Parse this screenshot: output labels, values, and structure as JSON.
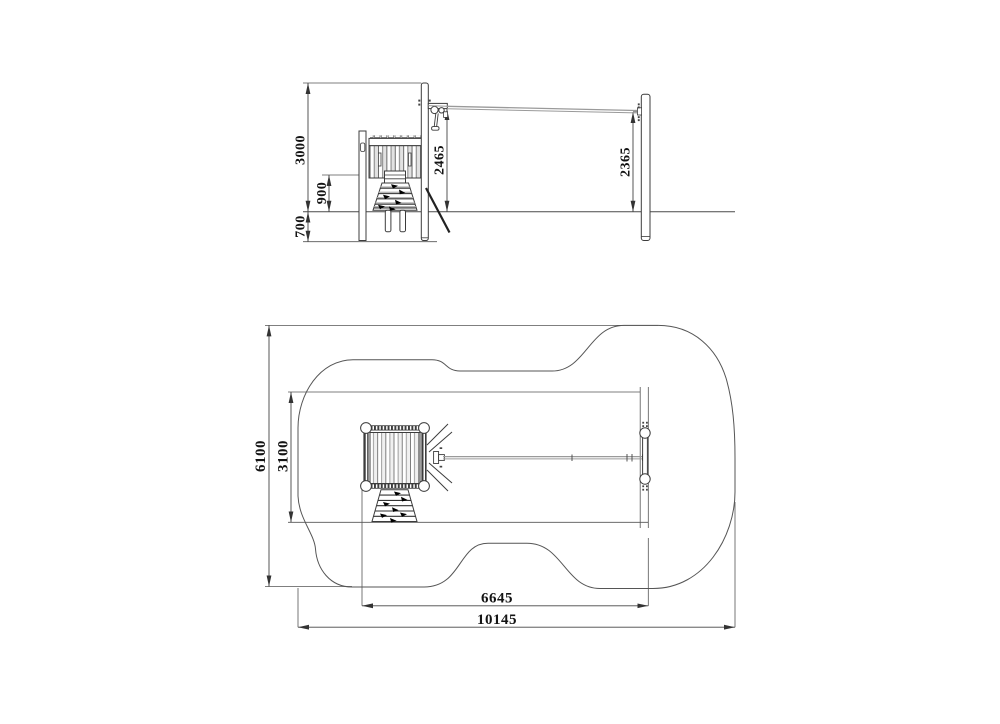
{
  "page": {
    "background": "#ffffff"
  },
  "drawing": {
    "kind": "technical installation drawing",
    "subject": "playground cableway (zipwire) with start tower and end post",
    "units": "mm",
    "line_color": "#3c3c3c",
    "cable_color": "#9a9a9a",
    "elevation": {
      "name": "side-elevation",
      "dims": {
        "mast_height": "3000",
        "platform_height": "900",
        "foundation_depth": "700",
        "cable_height_start": "2465",
        "cable_height_end": "2365"
      }
    },
    "plan": {
      "name": "plan-view",
      "dims": {
        "safety_zone_width": "6100",
        "frame_width": "3100",
        "span_length": "6645",
        "safety_zone_length": "10145"
      }
    }
  }
}
